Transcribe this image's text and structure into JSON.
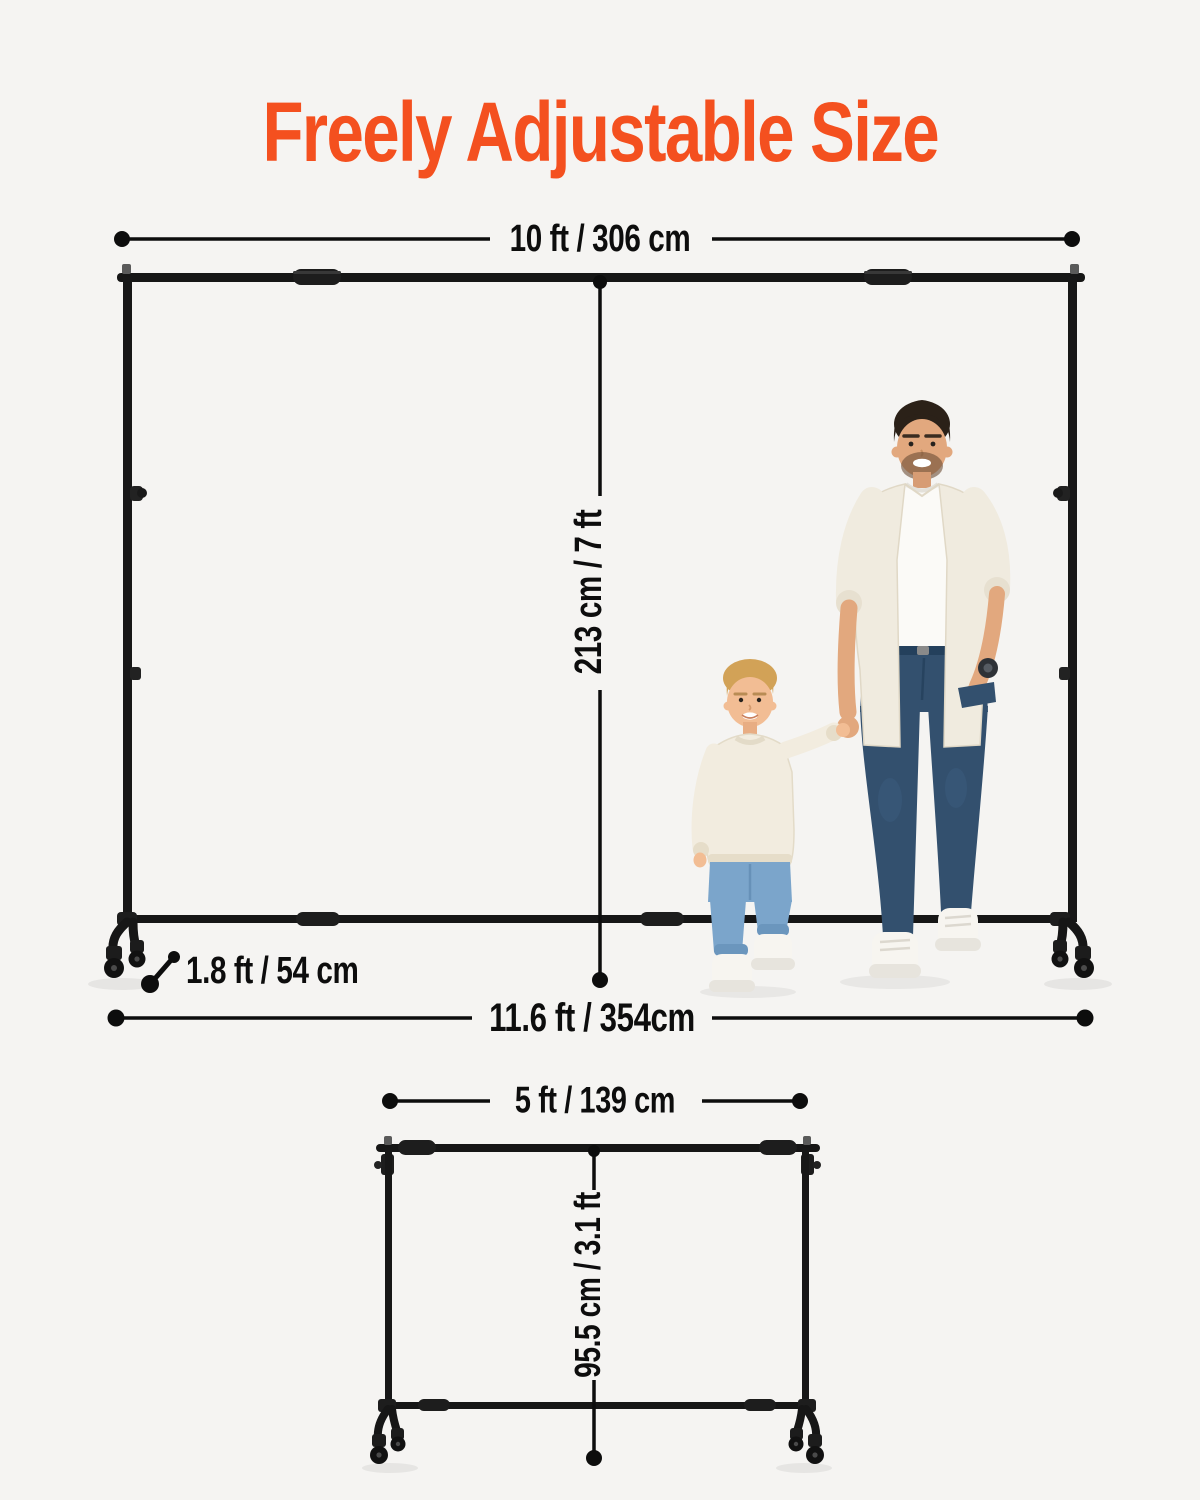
{
  "title": {
    "text": "Freely Adjustable Size"
  },
  "dimensions": {
    "large_stand": {
      "top_width": "10 ft / 306 cm",
      "height": "213 cm / 7 ft",
      "base_depth": "1.8 ft / 54 cm",
      "bottom_width": "11.6 ft / 354cm"
    },
    "small_stand": {
      "width": "5 ft / 139 cm",
      "height": "95.5 cm / 3.1 ft"
    }
  },
  "colors": {
    "accent_orange": "#F4501F",
    "background": "#F5F4F2",
    "ink": "#0D0D0D",
    "frame_black": "#161616"
  }
}
